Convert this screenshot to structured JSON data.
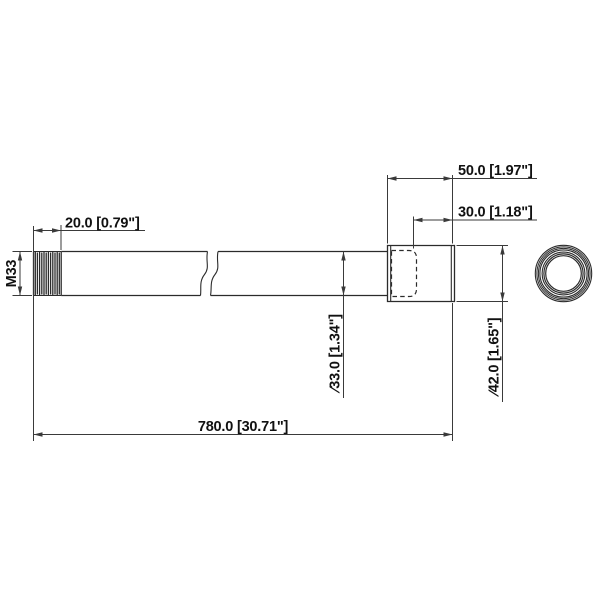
{
  "drawing": {
    "kind": "dimensioned mechanical part drawing (extension pole / threaded tube)",
    "labels": {
      "thread_spec": "M33",
      "thread_length": "20.0 [0.79\"]",
      "fitting_length": "50.0 [1.97\"]",
      "socket_depth": "30.0 [1.18\"]",
      "tube_diameter": "∕33.0 [1.34\"]",
      "fitting_diameter": "∕42.0 [1.65\"]",
      "overall_length": "780.0 [30.71\"]"
    },
    "colors": {
      "background": "#ffffff",
      "line": "#2b2b2b",
      "dimension": "#3a3a3a",
      "text": "#111111"
    }
  }
}
